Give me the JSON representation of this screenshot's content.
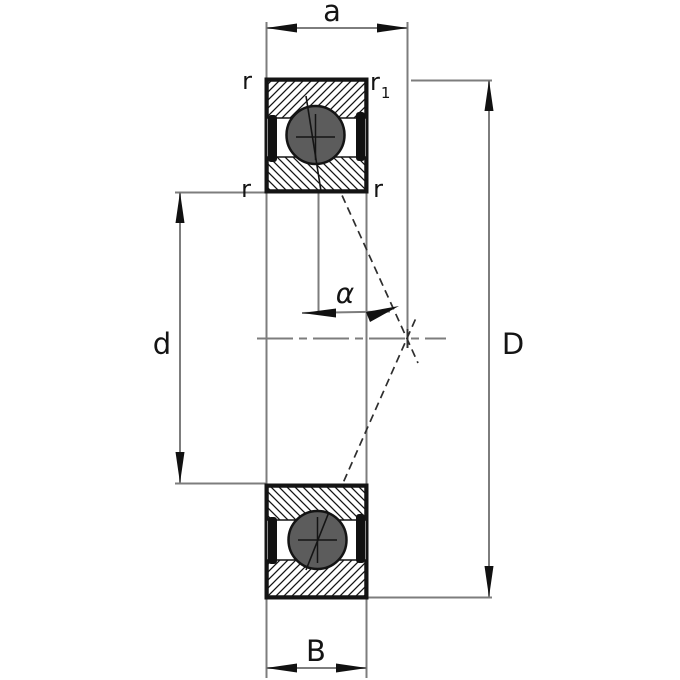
{
  "diagram": {
    "type": "bearing-cross-section",
    "labels": {
      "a": "a",
      "r_top_left": "r",
      "r1_base": "r",
      "r1_sub": "1",
      "r_mid_left": "r",
      "r_mid_right": "r",
      "d": "d",
      "D": "D",
      "alpha": "α",
      "B": "B"
    },
    "colors": {
      "background": "#ffffff",
      "thin_line": "#7d7d7d",
      "ink": "#141414",
      "ball_fill": "#5c5c5c",
      "seal_fill": "#111111"
    },
    "features": {
      "centerline_style": "dash-dot",
      "contact_lines_style": "dashed",
      "hatch": "diagonal"
    }
  }
}
